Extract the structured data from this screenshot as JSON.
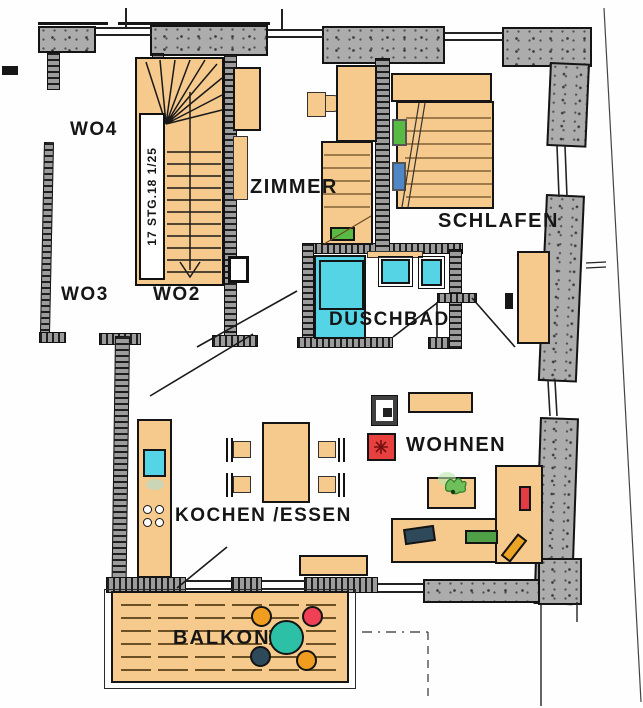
{
  "plan": {
    "title": "apartment-floor-plan",
    "rooms": {
      "wo4": "WO4",
      "wo3": "WO3",
      "wo2": "WO2",
      "zimmer": "ZIMMER",
      "schlafen": "SCHLAFEN",
      "duschbad": "DUSCHBAD",
      "wohnen": "WOHNEN",
      "kochen_essen": "KOCHEN /ESSEN",
      "balkon": "BALKON"
    },
    "stair": {
      "label": "17 STG.18 1/25"
    },
    "colors": {
      "paper": "#fefefe",
      "furniture_tan": "#f6c98c",
      "wall_concrete_gray": "#acacac",
      "wall_masonry_gray": "#9c9c9c",
      "line_black": "#141414",
      "water_cyan": "#55d4e6",
      "balcony_table_teal": "#2cc0a6",
      "accent_red": "#ef4056",
      "fireplace_red": "#e8403f",
      "accent_orange": "#f09c1f",
      "accent_navy": "#2e4a5a",
      "pillow_green": "#58bb44",
      "pillow_blue": "#4f86c6",
      "plank_brown": "#6b5026"
    }
  }
}
